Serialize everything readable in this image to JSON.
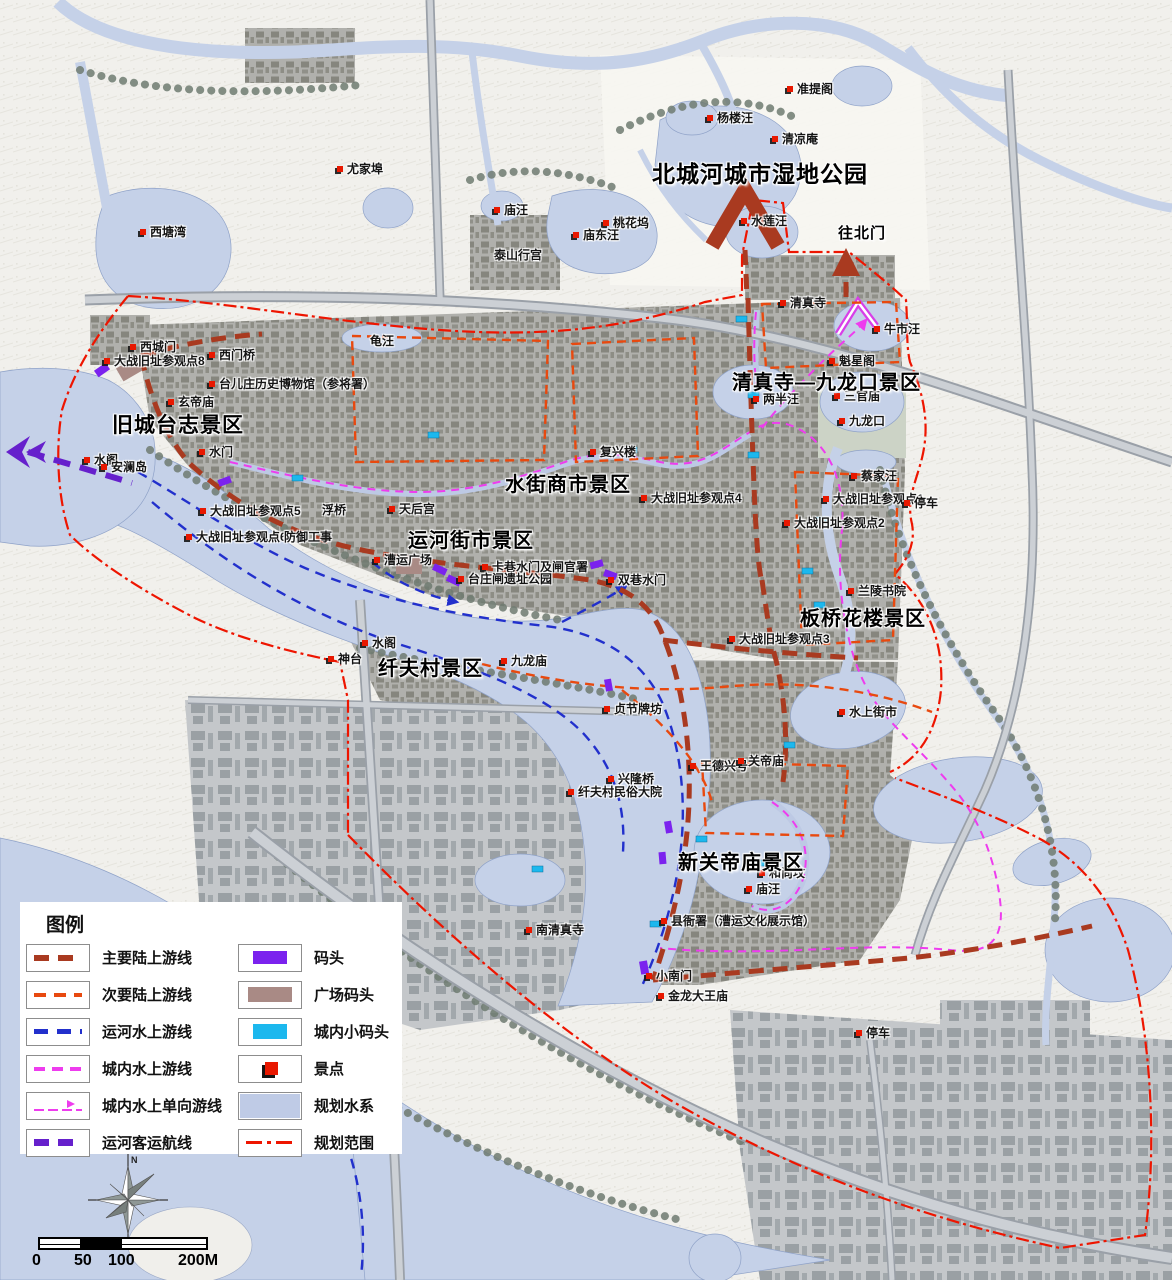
{
  "map": {
    "width": 1172,
    "height": 1280,
    "colors": {
      "main_land_route": "#a93a20",
      "secondary_land_route": "#e8490f",
      "canal_water_route": "#2230cc",
      "city_water_route": "#ee3cee",
      "passenger_route": "#6620cc",
      "dock": "#7b22ee",
      "plaza_dock": "#a98a85",
      "small_dock": "#1cb8ee",
      "scenic_spot": "#e81800",
      "planned_water": "#c5d1e8",
      "planning_boundary": "#ee1500"
    },
    "area_labels": [
      {
        "text": "北城河城市湿地公园",
        "x": 652,
        "y": 155,
        "size": 23
      },
      {
        "text": "往北门",
        "x": 838,
        "y": 222,
        "size": 15
      },
      {
        "text": "清真寺—九龙口景区",
        "x": 732,
        "y": 366,
        "size": 20
      },
      {
        "text": "旧城台志景区",
        "x": 112,
        "y": 409,
        "size": 21
      },
      {
        "text": "水街商市景区",
        "x": 505,
        "y": 468,
        "size": 20
      },
      {
        "text": "运河街市景区",
        "x": 408,
        "y": 524,
        "size": 20
      },
      {
        "text": "板桥花楼景区",
        "x": 800,
        "y": 602,
        "size": 20
      },
      {
        "text": "纤夫村景区",
        "x": 378,
        "y": 652,
        "size": 20
      },
      {
        "text": "新关帝庙景区",
        "x": 678,
        "y": 846,
        "size": 20
      }
    ],
    "pois": [
      {
        "text": "准提阁",
        "x": 787,
        "y": 80
      },
      {
        "text": "杨楼汪",
        "x": 707,
        "y": 109
      },
      {
        "text": "清凉庵",
        "x": 772,
        "y": 130
      },
      {
        "text": "尤家埠",
        "x": 337,
        "y": 160
      },
      {
        "text": "西塘湾",
        "x": 140,
        "y": 223
      },
      {
        "text": "庙汪",
        "x": 494,
        "y": 201
      },
      {
        "text": "桃花坞",
        "x": 603,
        "y": 214
      },
      {
        "text": "庙东汪",
        "x": 573,
        "y": 226
      },
      {
        "text": "水莲汪",
        "x": 741,
        "y": 212
      },
      {
        "text": "泰山行宫",
        "x": 494,
        "y": 246,
        "dot": false
      },
      {
        "text": "龟汪",
        "x": 370,
        "y": 332,
        "dot": false
      },
      {
        "text": "清真寺",
        "x": 780,
        "y": 294
      },
      {
        "text": "牛市汪",
        "x": 874,
        "y": 320
      },
      {
        "text": "西城门",
        "x": 130,
        "y": 338
      },
      {
        "text": "大战旧址参观点8",
        "x": 104,
        "y": 352
      },
      {
        "text": "西门桥",
        "x": 209,
        "y": 346
      },
      {
        "text": "台儿庄历史博物馆（参将署）",
        "x": 209,
        "y": 375
      },
      {
        "text": "玄帝庙",
        "x": 168,
        "y": 393
      },
      {
        "text": "水门",
        "x": 199,
        "y": 443
      },
      {
        "text": "水阁",
        "x": 84,
        "y": 451
      },
      {
        "text": "安澜岛",
        "x": 101,
        "y": 458
      },
      {
        "text": "大战旧址参观点5",
        "x": 200,
        "y": 502
      },
      {
        "text": "浮桥",
        "x": 322,
        "y": 501,
        "dot": false
      },
      {
        "text": "大战旧址参观点6",
        "x": 186,
        "y": 528
      },
      {
        "text": "防御工事",
        "x": 284,
        "y": 528,
        "dot": false
      },
      {
        "text": "天后宫",
        "x": 389,
        "y": 500
      },
      {
        "text": "漕运广场",
        "x": 374,
        "y": 551
      },
      {
        "text": "卡巷水门及闸官署",
        "x": 482,
        "y": 558
      },
      {
        "text": "台庄闸遗址公园",
        "x": 458,
        "y": 570
      },
      {
        "text": "双巷水门",
        "x": 608,
        "y": 571
      },
      {
        "text": "复兴楼",
        "x": 590,
        "y": 443
      },
      {
        "text": "大战旧址参观点4",
        "x": 641,
        "y": 489
      },
      {
        "text": "两半汪",
        "x": 753,
        "y": 390
      },
      {
        "text": "三官庙",
        "x": 834,
        "y": 387
      },
      {
        "text": "九龙口",
        "x": 839,
        "y": 412
      },
      {
        "text": "魁星阁",
        "x": 829,
        "y": 352
      },
      {
        "text": "蔡家汪",
        "x": 851,
        "y": 467
      },
      {
        "text": "大战旧址参观点1",
        "x": 823,
        "y": 490
      },
      {
        "text": "停车",
        "x": 904,
        "y": 494
      },
      {
        "text": "大战旧址参观点2",
        "x": 784,
        "y": 514
      },
      {
        "text": "兰陵书院",
        "x": 848,
        "y": 582
      },
      {
        "text": "大战旧址参观点3",
        "x": 729,
        "y": 630
      },
      {
        "text": "水上街市",
        "x": 839,
        "y": 703
      },
      {
        "text": "水阁",
        "x": 362,
        "y": 634
      },
      {
        "text": "神台",
        "x": 328,
        "y": 650
      },
      {
        "text": "九龙庙",
        "x": 501,
        "y": 652
      },
      {
        "text": "贞节牌坊",
        "x": 604,
        "y": 700
      },
      {
        "text": "兴隆桥",
        "x": 608,
        "y": 770
      },
      {
        "text": "纤夫村民俗大院",
        "x": 568,
        "y": 783
      },
      {
        "text": "王德兴号",
        "x": 690,
        "y": 757
      },
      {
        "text": "关帝庙",
        "x": 738,
        "y": 752
      },
      {
        "text": "和尚坟",
        "x": 759,
        "y": 864
      },
      {
        "text": "庙汪",
        "x": 746,
        "y": 880
      },
      {
        "text": "县衙署（漕运文化展示馆）",
        "x": 661,
        "y": 912
      },
      {
        "text": "南清真寺",
        "x": 526,
        "y": 921
      },
      {
        "text": "小南门",
        "x": 646,
        "y": 967
      },
      {
        "text": "金龙大王庙",
        "x": 658,
        "y": 987
      },
      {
        "text": "停车",
        "x": 856,
        "y": 1024
      }
    ]
  },
  "legend": {
    "title": "图例",
    "left_items": [
      {
        "label": "主要陆上游线",
        "swatch": "sw-main"
      },
      {
        "label": "次要陆上游线",
        "swatch": "sw-secondary"
      },
      {
        "label": "运河水上游线",
        "swatch": "sw-canal"
      },
      {
        "label": "城内水上游线",
        "swatch": "sw-city"
      },
      {
        "label": "城内水上单向游线",
        "swatch": "sw-oneway"
      },
      {
        "label": "运河客运航线",
        "swatch": "sw-passenger"
      }
    ],
    "right_items": [
      {
        "label": "码头",
        "swatch": "sw-dock"
      },
      {
        "label": "广场码头",
        "swatch": "sw-plaza"
      },
      {
        "label": "城内小码头",
        "swatch": "sw-smalldock"
      },
      {
        "label": "景点",
        "swatch": "sw-spot"
      },
      {
        "label": "规划水系",
        "swatch": "sw-water"
      },
      {
        "label": "规划范围",
        "swatch": "sw-boundary"
      }
    ]
  },
  "scalebar": {
    "labels": [
      "0",
      "50",
      "100",
      "200M"
    ]
  },
  "compass": {
    "north_label": "N"
  }
}
